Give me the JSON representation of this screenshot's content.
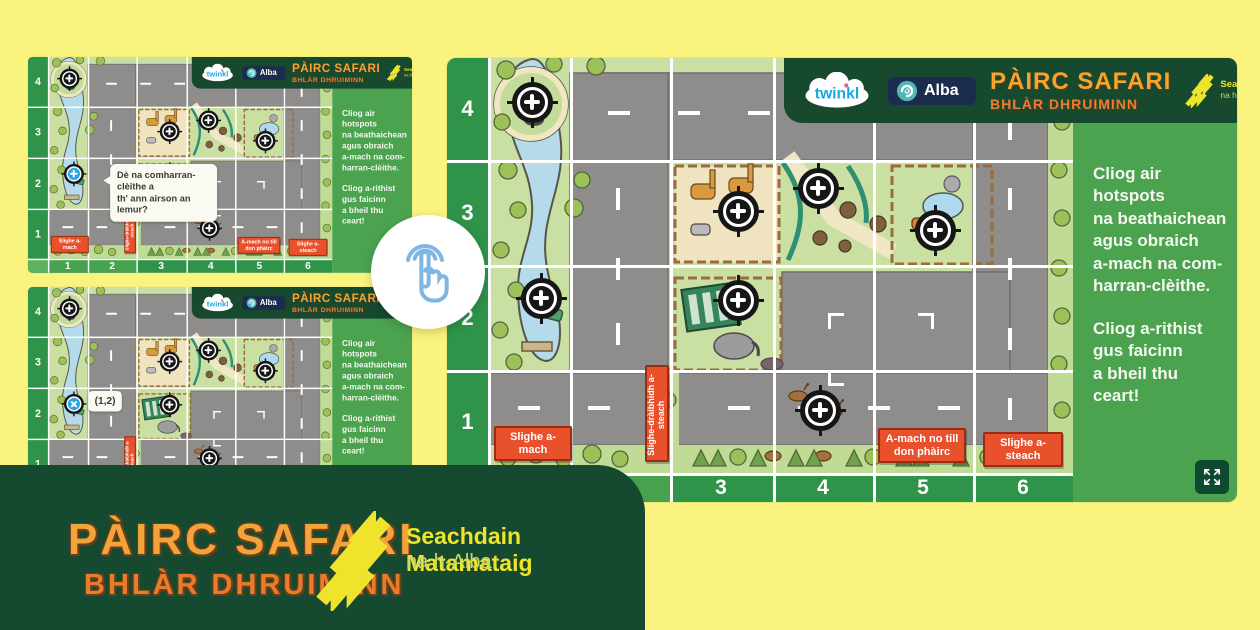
{
  "brand": {
    "twinkl": "twinkl",
    "alba": "Alba",
    "title_line1": "PÀIRC SAFARI",
    "title_line2": "BHLÀR DHRUIMINN",
    "mws_line1": "Seachdain Matamataig",
    "mws_line2": "na h-Alba"
  },
  "instructions": {
    "para1": "Cliog air hotspots\nna beathaichean\nagus obraich\na-mach na com-\nharran-clèithe.",
    "para2": "Cliog a-rithist\ngus faicinn\na bheil thu ceart!"
  },
  "grid": {
    "rows": [
      "4",
      "3",
      "2",
      "1"
    ],
    "cols": [
      "1",
      "2",
      "3",
      "4",
      "5",
      "6"
    ]
  },
  "map_labels": {
    "way_out": "Slighe a-mach",
    "drive_in": "Slighe-dràibhidh a-steach",
    "exit_or_return": "A-mach no till don phàirc",
    "way_in": "Slighe a-steach"
  },
  "question_bubble": "Dè na comharran-clèithe a\nth' ann airson an lemur?",
  "answer_label": "(1,2)",
  "hotspots": {
    "cells": [
      [
        1,
        4
      ],
      [
        1,
        2
      ],
      [
        3,
        3
      ],
      [
        4,
        3
      ],
      [
        5,
        3
      ],
      [
        3,
        2
      ],
      [
        4,
        1
      ]
    ],
    "highlighted_cell": [
      1,
      2
    ]
  },
  "colors": {
    "background_yellow": "#FAF37E",
    "banner_green": "#154A31",
    "panel_green": "#4BA350",
    "label_orange": "#E8512B",
    "highlight_blue": "#2AA7E2",
    "title_orange": "#F2A33A",
    "mws_yellow": "#F0E32B"
  }
}
